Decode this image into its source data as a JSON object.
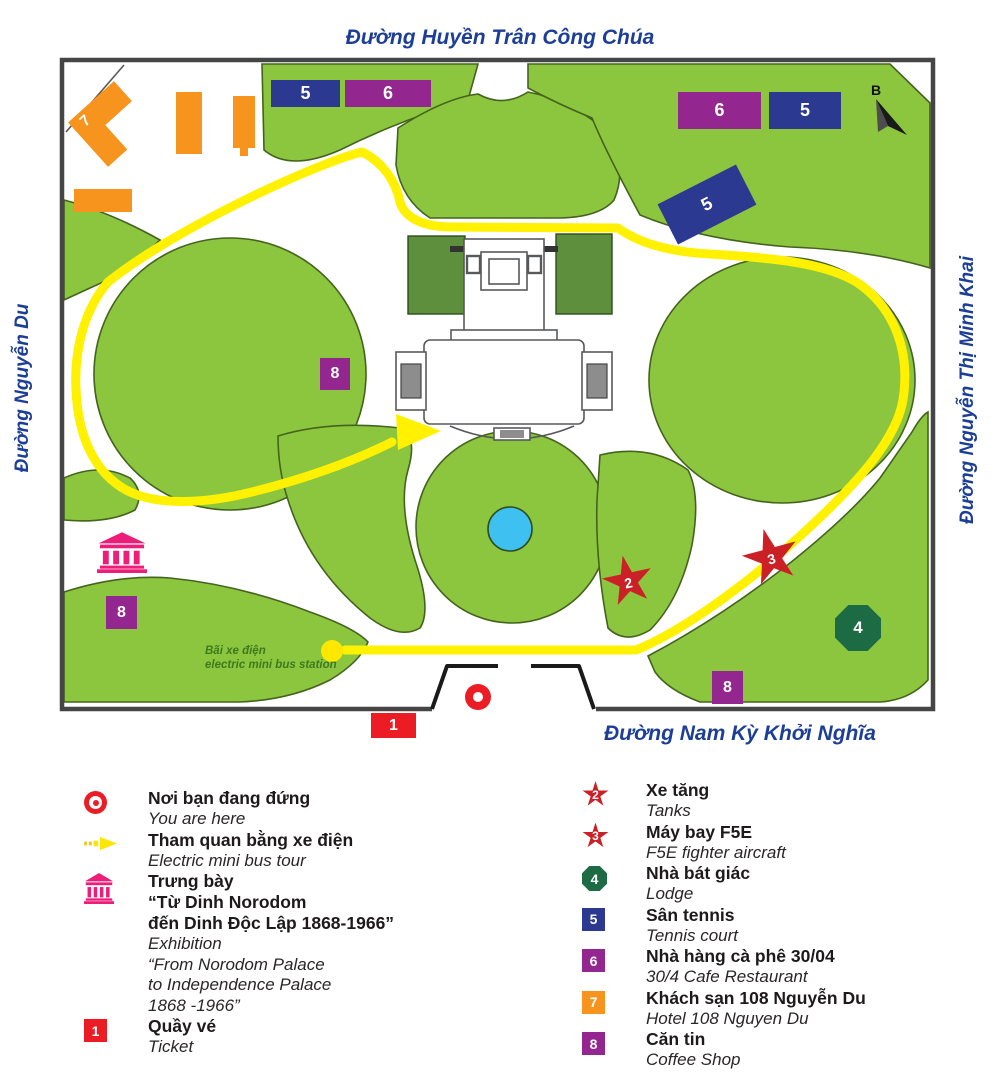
{
  "streets": {
    "top": "Đường Huyền Trân Công Chúa",
    "left": "Đường Nguyễn Du",
    "right": "Đường Nguyễn Thị Minh Khai",
    "bottom": "Đường  Nam Kỳ Khởi Nghĩa"
  },
  "compass_label": "B",
  "bus_station": {
    "line1": "Bãi xe điện",
    "line2": "electric mini bus station"
  },
  "colors": {
    "lawn_green": "#8CC63E",
    "garden_dark_green": "#5E8F3D",
    "route_yellow": "#FFF100",
    "street_text_blue": "#1C3E97",
    "marker_blue": "#2B3990",
    "marker_purple": "#93278F",
    "marker_orange": "#F7941E",
    "marker_red": "#EC1C24",
    "star_red": "#CC2027",
    "octagon_green": "#1C6B45",
    "museum_pink": "#ED1E79",
    "fountain_blue": "#3EC1F0"
  },
  "map_markers": [
    {
      "shape": "rect",
      "color": "#2B3990",
      "label": "5",
      "x": 271,
      "y": 80,
      "w": 69,
      "h": 27
    },
    {
      "shape": "rect",
      "color": "#93278F",
      "label": "6",
      "x": 345,
      "y": 80,
      "w": 86,
      "h": 27
    },
    {
      "shape": "rect",
      "color": "#93278F",
      "label": "6",
      "x": 678,
      "y": 92,
      "w": 83,
      "h": 37
    },
    {
      "shape": "rect",
      "color": "#2B3990",
      "label": "5",
      "x": 769,
      "y": 92,
      "w": 72,
      "h": 37
    },
    {
      "shape": "rect",
      "color": "#2B3990",
      "label": "5",
      "x": 663,
      "y": 182,
      "w": 88,
      "h": 45,
      "rotate": -27
    },
    {
      "shape": "rect small",
      "color": "#93278F",
      "label": "8",
      "x": 320,
      "y": 358,
      "w": 30,
      "h": 32
    },
    {
      "shape": "rect small",
      "color": "#93278F",
      "label": "8",
      "x": 106,
      "y": 596,
      "w": 31,
      "h": 33
    },
    {
      "shape": "rect small",
      "color": "#93278F",
      "label": "8",
      "x": 712,
      "y": 671,
      "w": 31,
      "h": 33
    },
    {
      "shape": "rect small",
      "color": "#EC1C24",
      "label": "1",
      "x": 371,
      "y": 713,
      "w": 45,
      "h": 25
    },
    {
      "shape": "star",
      "color": "#CC2027",
      "label": "2",
      "x": 602,
      "y": 555,
      "w": 52,
      "h": 52,
      "rotate": -12
    },
    {
      "shape": "star",
      "color": "#CC2027",
      "label": "3",
      "x": 742,
      "y": 528,
      "w": 58,
      "h": 58,
      "rotate": -15
    },
    {
      "shape": "octagon",
      "color": "#1C6B45",
      "label": "4",
      "x": 835,
      "y": 605,
      "w": 46,
      "h": 46
    },
    {
      "shape": "building7",
      "color": "#F7941E",
      "label": "7",
      "x": 80,
      "y": 94,
      "w": 62,
      "h": 60,
      "rotate": -42
    }
  ],
  "legend": {
    "left": [
      {
        "icon": "you-are-here",
        "vi": [
          "Nơi bạn đang đứng"
        ],
        "en": [
          "You are here"
        ]
      },
      {
        "icon": "bus-arrow",
        "vi": [
          "Tham quan bằng xe điện"
        ],
        "en": [
          "Electric mini bus tour"
        ]
      },
      {
        "icon": "museum",
        "vi": [
          "Trưng bày",
          "“Từ Dinh Norodom",
          "đến Dinh Độc Lập 1868-1966”"
        ],
        "en": [
          " Exhibition",
          "“From Norodom Palace",
          "to Independence Palace",
          "1868 -1966”"
        ]
      },
      {
        "icon": "square",
        "color": "#EC1C24",
        "label": "1",
        "vi": [
          "Quầy vé"
        ],
        "en": [
          "Ticket"
        ]
      }
    ],
    "right": [
      {
        "icon": "star",
        "color": "#CC2027",
        "label": "2",
        "vi": [
          "Xe tăng"
        ],
        "en": [
          "Tanks"
        ]
      },
      {
        "icon": "star",
        "color": "#CC2027",
        "label": "3",
        "vi": [
          "Máy bay F5E"
        ],
        "en": [
          "F5E fighter aircraft"
        ]
      },
      {
        "icon": "octagon",
        "color": "#1C6B45",
        "label": "4",
        "vi": [
          "Nhà bát giác"
        ],
        "en": [
          "Lodge"
        ]
      },
      {
        "icon": "square",
        "color": "#2B3990",
        "label": "5",
        "vi": [
          "Sân tennis"
        ],
        "en": [
          "Tennis court"
        ]
      },
      {
        "icon": "square",
        "color": "#93278F",
        "label": "6",
        "vi": [
          "Nhà hàng cà phê 30/04"
        ],
        "en": [
          "30/4 Cafe Restaurant"
        ]
      },
      {
        "icon": "square",
        "color": "#F7941E",
        "label": "7",
        "vi": [
          "Khách sạn 108 Nguyễn Du"
        ],
        "en": [
          "Hotel 108 Nguyen Du"
        ]
      },
      {
        "icon": "square",
        "color": "#93278F",
        "label": "8",
        "vi": [
          "Căn tin"
        ],
        "en": [
          "Coffee Shop"
        ]
      }
    ]
  }
}
